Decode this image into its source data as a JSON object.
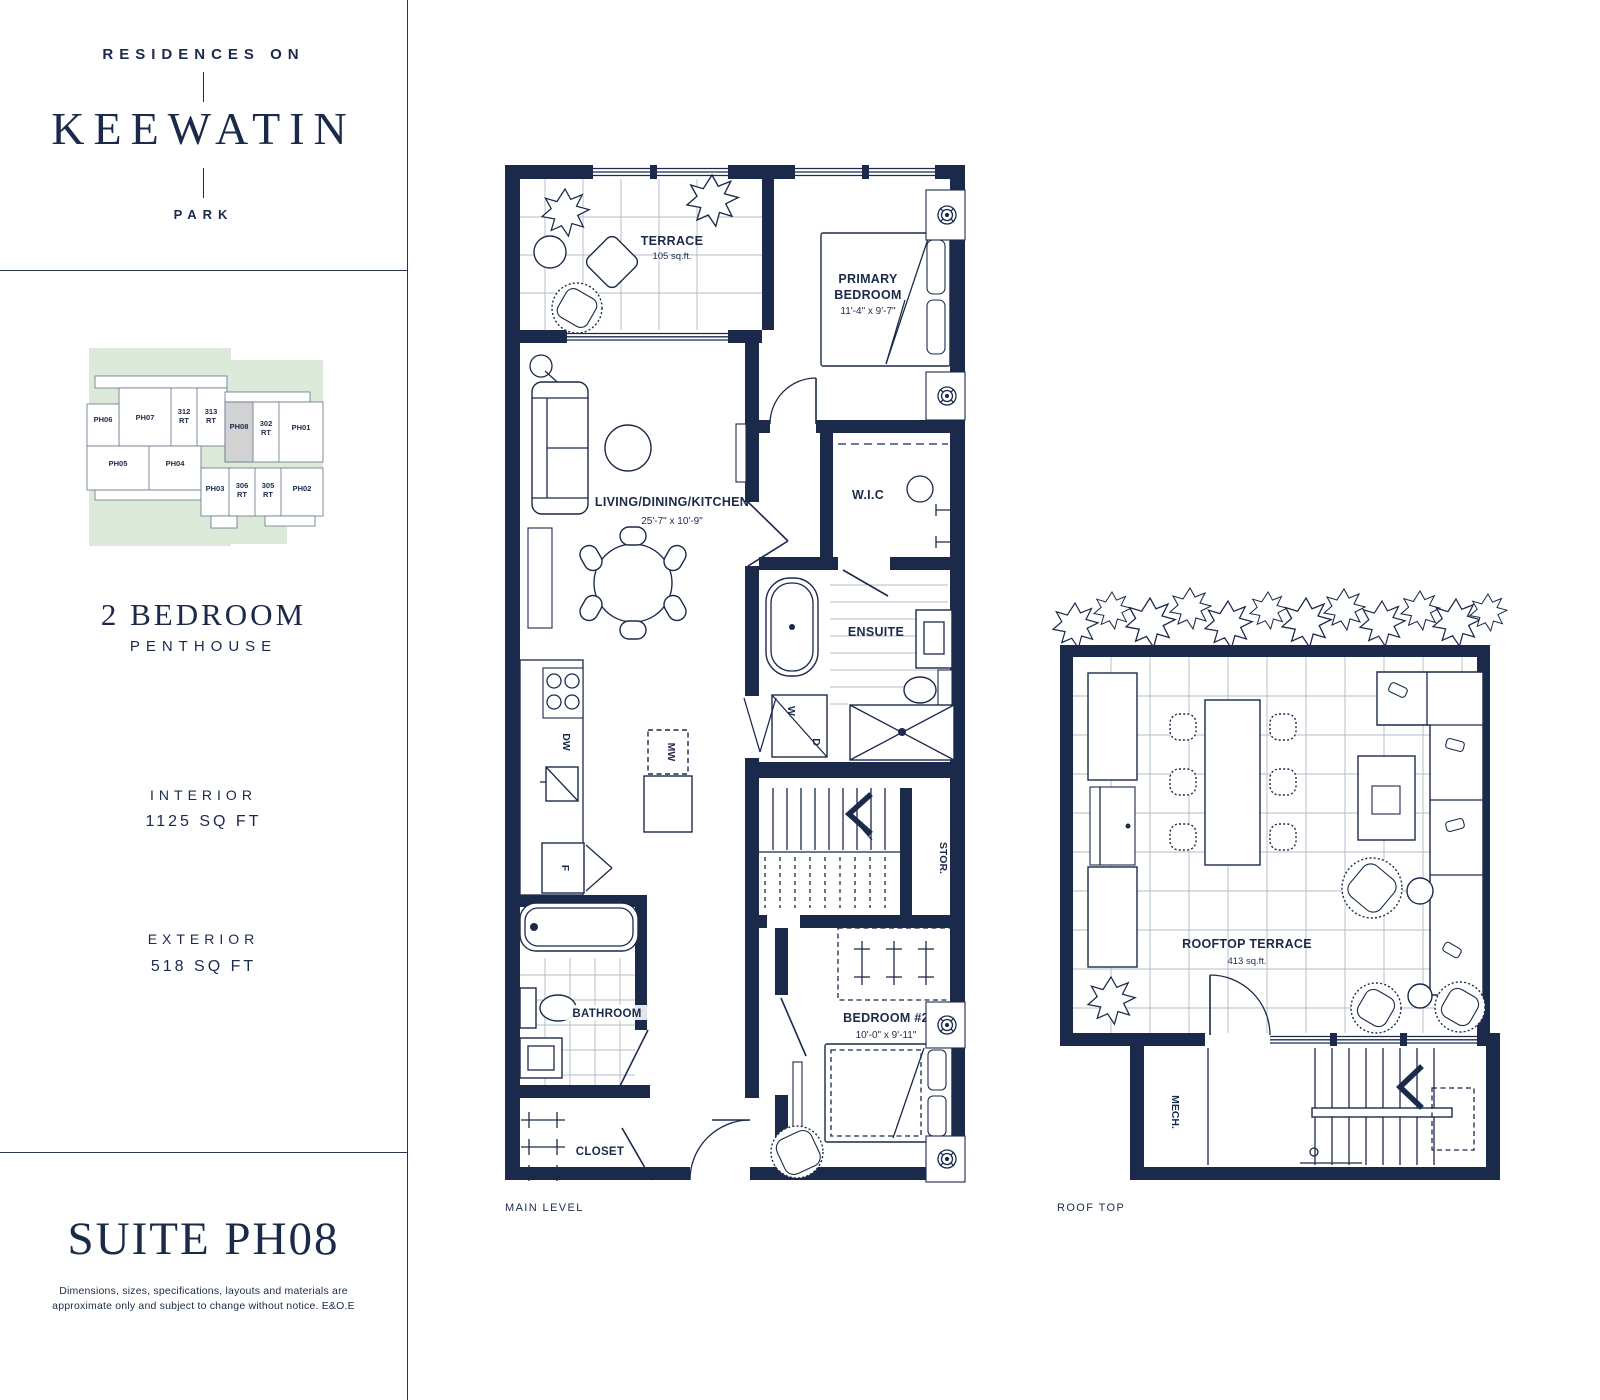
{
  "colors": {
    "navy": "#1b2a4a",
    "keyplan_green": "#dcead9",
    "highlight_gray": "#d2d2d2",
    "white": "#ffffff"
  },
  "brand": {
    "top": "RESIDENCES ON",
    "name": "KEEWATIN",
    "bottom": "PARK"
  },
  "keyplan": {
    "units": [
      {
        "id": "PH06"
      },
      {
        "id": "PH07"
      },
      {
        "id": "312",
        "suffix": "RT"
      },
      {
        "id": "313",
        "suffix": "RT"
      },
      {
        "id": "PH08",
        "highlighted": true
      },
      {
        "id": "302",
        "suffix": "RT"
      },
      {
        "id": "PH01"
      },
      {
        "id": "PH05"
      },
      {
        "id": "PH04"
      },
      {
        "id": "PH03"
      },
      {
        "id": "306",
        "suffix": "RT"
      },
      {
        "id": "305",
        "suffix": "RT"
      },
      {
        "id": "PH02"
      }
    ]
  },
  "summary": {
    "type_main": "2 BEDROOM",
    "type_sub": "PENTHOUSE",
    "interior_label": "INTERIOR",
    "interior_value": "1125 SQ FT",
    "exterior_label": "EXTERIOR",
    "exterior_value": "518 SQ FT"
  },
  "suite": {
    "title": "SUITE PH08",
    "disclaimer1": "Dimensions, sizes, specifications, layouts and materials are",
    "disclaimer2": "approximate only and subject to change without notice. E&O.E"
  },
  "main_level": {
    "caption": "MAIN LEVEL",
    "terrace": {
      "name": "TERRACE",
      "area": "105 sq.ft."
    },
    "primary": {
      "line1": "PRIMARY",
      "line2": "BEDROOM",
      "dims": "11'-4\" x 9'-7\""
    },
    "living": {
      "name": "LIVING/DINING/KITCHEN",
      "dims": "25'-7\" x 10'-9\""
    },
    "wic": "W.I.C",
    "ensuite": "ENSUITE",
    "stor": "STOR.",
    "bathroom": "BATHROOM",
    "closet": "CLOSET",
    "bedroom2": {
      "name": "BEDROOM #2",
      "dims": "10'-0\" x 9'-11\""
    },
    "appliances": {
      "dw": "DW",
      "mw": "MW",
      "f": "F",
      "w": "W",
      "d": "D"
    }
  },
  "roof": {
    "caption": "ROOF TOP",
    "terrace": {
      "name": "ROOFTOP TERRACE",
      "area": "413 sq.ft."
    },
    "mech": "MECH."
  }
}
